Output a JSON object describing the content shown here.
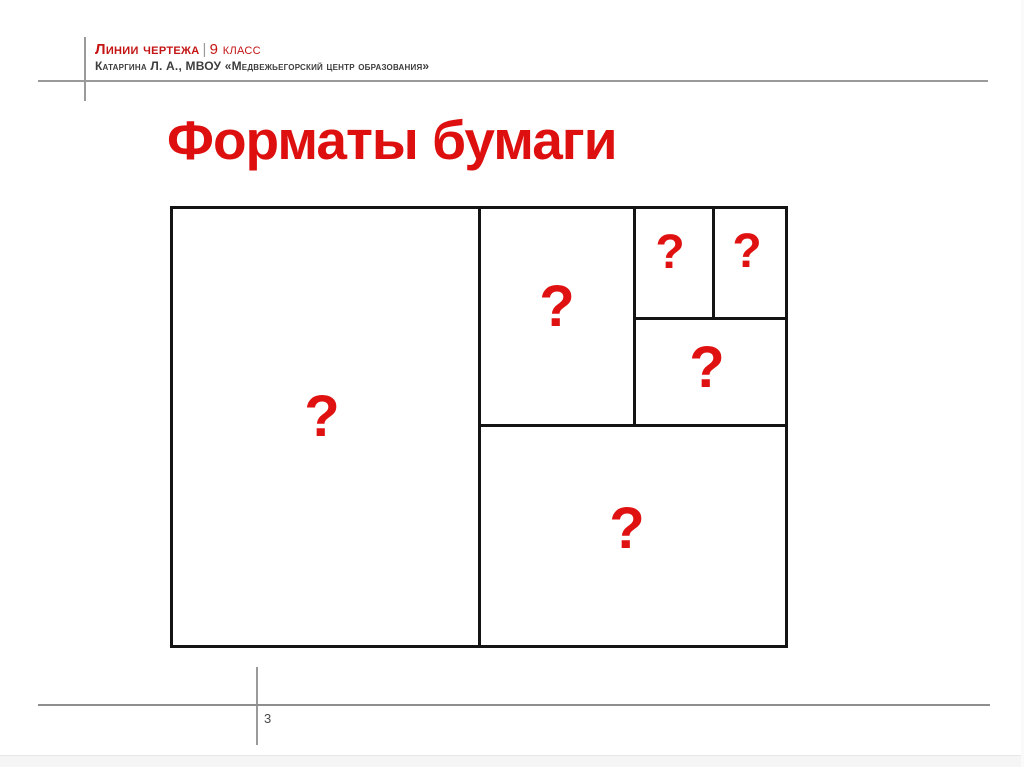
{
  "header": {
    "course": "Линии чертежа",
    "separator": "|",
    "grade": "9 класс",
    "author": "Катаргина Л. А., МВОУ «Медвежьегорский центр образования»"
  },
  "slide": {
    "title": "Форматы бумаги",
    "page_number": "3"
  },
  "diagram": {
    "description": "paper-format-subdivision-rectangle",
    "regions": [
      {
        "id": "a1-left-half",
        "label": "?"
      },
      {
        "id": "a3-top-middle",
        "label": "?"
      },
      {
        "id": "a5-small-left",
        "label": "?"
      },
      {
        "id": "a5-small-right",
        "label": "?"
      },
      {
        "id": "a4-middle-right",
        "label": "?"
      },
      {
        "id": "a2-bottom-right",
        "label": "?"
      }
    ]
  },
  "colors": {
    "accent_red": "#dd0f0f",
    "header_red": "#c41414",
    "line_black": "#141414",
    "line_gray": "#9a9a9a",
    "text_dark": "#3d3d3d"
  }
}
